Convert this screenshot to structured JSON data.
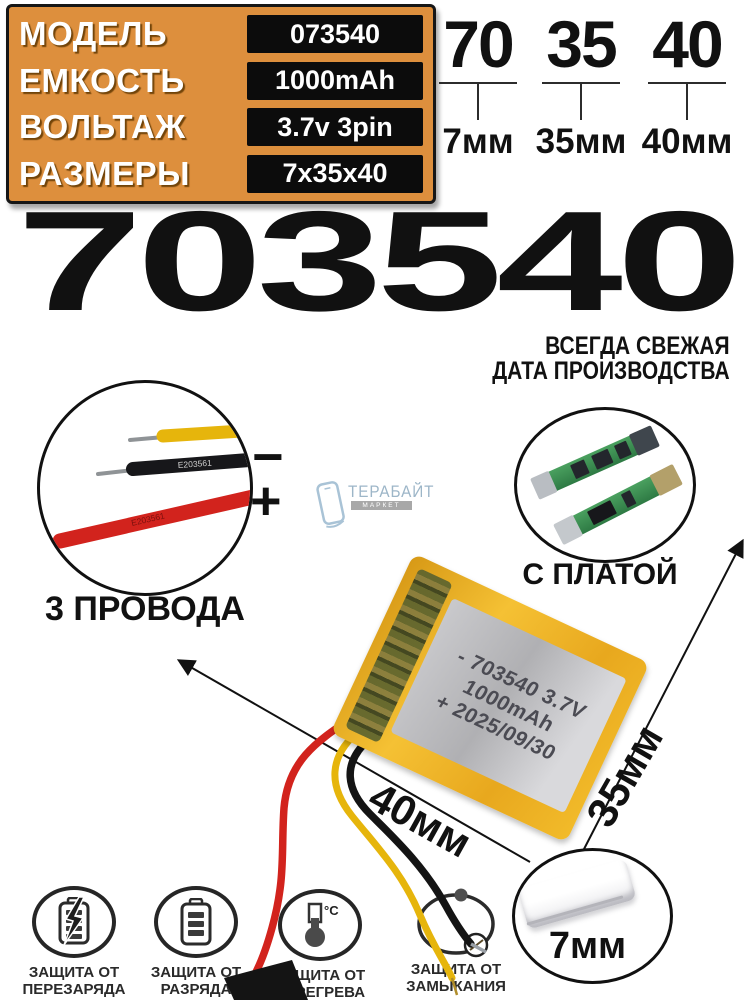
{
  "spec_table": {
    "rows": [
      {
        "label": "МОДЕЛЬ",
        "value": "073540"
      },
      {
        "label": "ЕМКОСТЬ",
        "value": "1000mAh"
      },
      {
        "label": "ВОЛЬТАЖ",
        "value": "3.7v 3pin"
      },
      {
        "label": "РАЗМЕРЫ",
        "value": "7x35x40"
      }
    ]
  },
  "size_callouts": [
    {
      "digits": "70",
      "mm": "7мм"
    },
    {
      "digits": "35",
      "mm": "35мм"
    },
    {
      "digits": "40",
      "mm": "40мм"
    }
  ],
  "title": "703540",
  "freshness": {
    "line1": "ВСЕГДА СВЕЖАЯ",
    "line2": "ДАТА ПРОИЗВОДСТВА"
  },
  "wires_photo": {
    "caption": "3 ПРОВОДА",
    "minus_sign": "−",
    "plus_sign": "+",
    "black_wire_marking": "E203561",
    "red_wire_marking": "E203561"
  },
  "pcb_photo": {
    "caption": "С ПЛАТОЙ"
  },
  "watermark": {
    "name": "ТЕРАБАЙТ",
    "sub": "МАРКЕТ"
  },
  "battery_print": {
    "line1": "- 703540 3.7V",
    "line2": "1000mAh",
    "line3": "+ 2025/09/30"
  },
  "dimension_arrows": {
    "width_label": "40мм",
    "height_label": "35мм",
    "thickness_label": "7мм"
  },
  "protections": [
    {
      "line1": "ЗАЩИТА ОТ",
      "line2": "ПЕРЕЗАРЯДА"
    },
    {
      "line1": "ЗАЩИТА ОТ",
      "line2": "РАЗРЯДА"
    },
    {
      "line1": "ЗАЩИТА ОТ",
      "line2": "ПЕРЕГРЕВА"
    },
    {
      "line1": "ЗАЩИТА ОТ",
      "line2": "ЗАМЫКАНИЯ"
    }
  ],
  "thermometer_unit": "°C",
  "colors": {
    "accent_orange": "#DD8F3D",
    "value_box_black": "#0C0C0C",
    "pcb_green": "#3E8E53",
    "wire_red": "#D2231D",
    "wire_yellow": "#E6B50C",
    "battery_yellow": "#F0B425"
  }
}
